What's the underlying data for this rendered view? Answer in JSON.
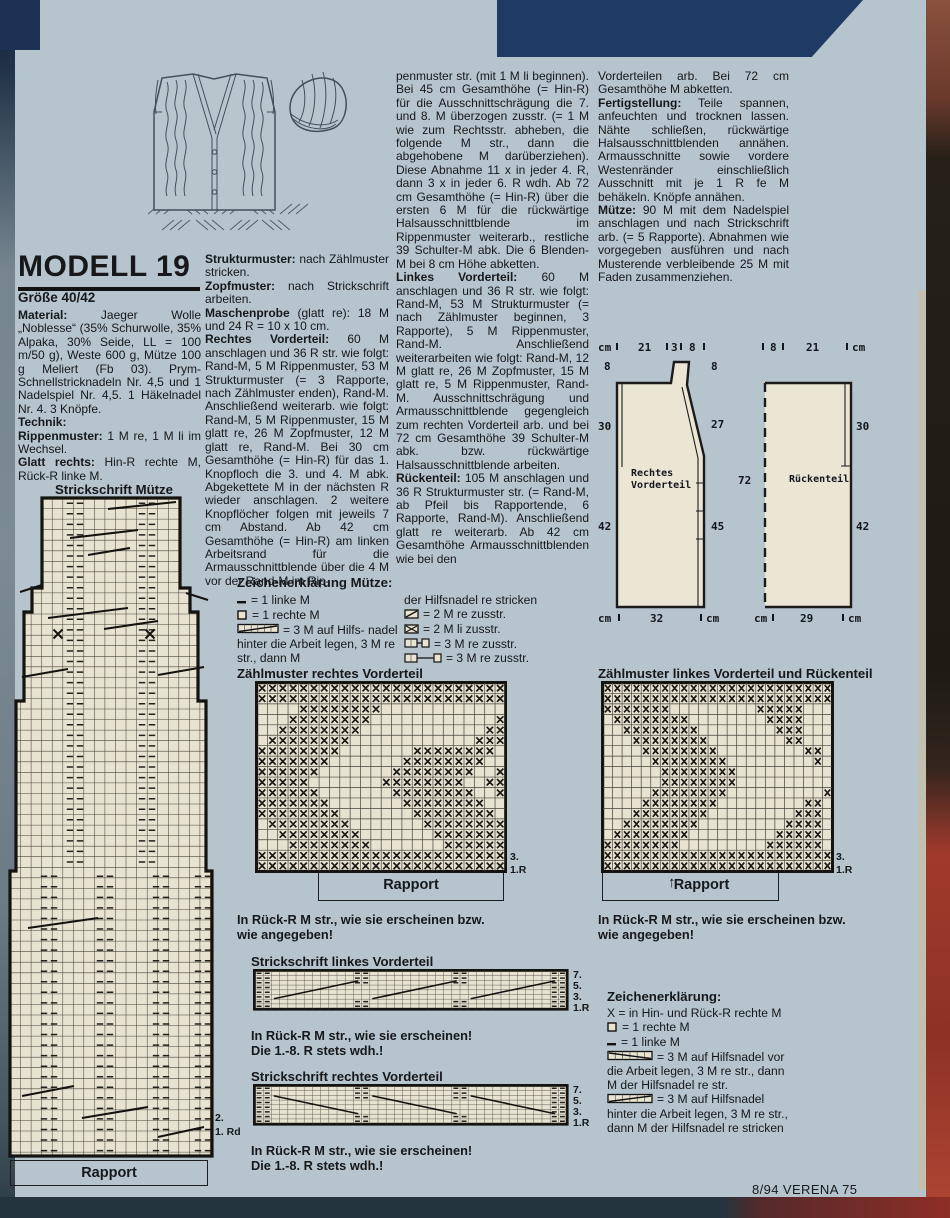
{
  "page": {
    "footer": "8/94 VERENA 75"
  },
  "header": {
    "title": "MODELL 19",
    "size": "Größe 40/42"
  },
  "col1": {
    "paragraphs": [
      {
        "lead": "Material:",
        "text": " Jaeger Wolle „Noblesse“ (35% Schurwolle, 35% Alpaka, 30% Seide, LL = 100 m/50 g), Weste 600 g, Mütze 100 g Meliert (Fb 03). Prym-Schnellstricknadeln Nr. 4,5 und 1 Nadelspiel Nr. 4,5. 1 Häkelnadel Nr. 4. 3 Knöpfe."
      },
      {
        "lead": "Technik:",
        "text": ""
      },
      {
        "lead": "Rippenmuster:",
        "text": " 1 M re, 1 M li im Wechsel."
      },
      {
        "lead": "Glatt rechts:",
        "text": " Hin-R rechte M, Rück-R linke M."
      }
    ]
  },
  "col2": {
    "paragraphs": [
      {
        "lead": "Strukturmuster:",
        "text": " nach Zählmuster stricken."
      },
      {
        "lead": "Zopfmuster:",
        "text": " nach Strickschrift arbeiten."
      },
      {
        "lead": "Maschenprobe",
        "text": " (glatt re): 18 M und 24 R = 10 x 10 cm."
      },
      {
        "lead": "Rechtes Vorderteil:",
        "text": " 60 M anschlagen und 36 R str. wie folgt: Rand-M, 5 M Rippenmuster, 53 M Strukturmuster (= 3 Rapporte, nach Zählmuster enden), Rand-M. Anschließend weiterarb. wie folgt: Rand-M, 5 M Rippenmuster, 15 M glatt re, 26 M Zopfmuster, 12 M glatt re, Rand-M. Bei 30 cm Gesamthöhe (= Hin-R) für das 1. Knopfloch die 3. und 4. M abk. Abgekettete M in der nächsten R wieder anschlagen. 2 weitere Knopflöcher folgen mit jeweils 7 cm Abstand. Ab 42 cm Gesamthöhe (= Hin-R) am linken Arbeitsrand für die Armausschnittblende über die 4 M vor der Rand-M im Rip-"
      }
    ]
  },
  "col3": {
    "paragraphs": [
      {
        "lead": "",
        "text": "penmuster str. (mit 1 M li beginnen). Bei 45 cm Gesamthöhe (= Hin-R) für die Ausschnittschrägung die 7. und 8. M überzogen zusstr. (= 1 M wie zum Rechtsstr. abheben, die folgende M str., dann die abgehobene M darüberziehen). Diese Abnahme 11 x in jeder 4. R, dann 3 x in jeder 6. R wdh. Ab 72 cm Gesamthöhe (= Hin-R) über die ersten 6 M für die rückwärtige Halsausschnittblende im Rippenmuster weiterarb., restliche 39 Schulter-M abk. Die 6 Blenden-M bei 8 cm Höhe abketten."
      },
      {
        "lead": "Linkes Vorderteil:",
        "text": " 60 M anschlagen und 36 R str. wie folgt: Rand-M, 53 M Strukturmuster (= nach Zählmuster beginnen, 3 Rapporte), 5 M Rippenmuster, Rand-M. Anschließend weiterarbeiten wie folgt: Rand-M, 12 M glatt re, 26 M Zopfmuster, 15 M glatt re, 5 M Rippenmuster, Rand-M. Ausschnittschrägung und Armausschnittblende gegengleich zum rechten Vorderteil arb. und bei 72 cm Gesamthöhe 39 Schulter-M abk. bzw. rückwärtige Halsausschnittblende arbeiten."
      },
      {
        "lead": "Rückenteil:",
        "text": " 105 M anschlagen und 36 R Strukturmuster str. (= Rand-M, ab Pfeil bis Rapportende, 6 Rapporte, Rand-M). Anschließend glatt re weiterarb. Ab 42 cm Gesamthöhe Armausschnittblenden wie bei den"
      }
    ]
  },
  "col4": {
    "paragraphs": [
      {
        "lead": "",
        "text": "Vorderteilen arb. Bei 72 cm Gesamthöhe M abketten."
      },
      {
        "lead": "Fertigstellung:",
        "text": " Teile spannen, anfeuchten und trocknen lassen. Nähte schließen, rückwärtige Halsausschnittblenden annähen. Armausschnitte sowie vordere Westenränder einschließlich Ausschnitt mit je 1 R fe M behäkeln. Knöpfe annähen."
      },
      {
        "lead": "Mütze:",
        "text": " 90 M mit dem Nadelspiel anschlagen und nach Strickschrift arb. (= 5 Rapporte). Abnahmen wie vorgegeben ausführen und nach Musterende verbleibende 25 M mit Faden zusammenziehen."
      }
    ]
  },
  "schematics": {
    "left": {
      "name": "Rechtes\nVorderteil",
      "top_labels": [
        "cm",
        "21",
        "3",
        "8"
      ],
      "left_labels": [
        "8",
        "30",
        "42"
      ],
      "right_labels": [
        "8",
        "27",
        "45"
      ],
      "bottom_labels": [
        "cm",
        "32",
        "cm"
      ]
    },
    "right": {
      "name": "Rückenteil",
      "top_labels": [
        "8",
        "21",
        "cm"
      ],
      "left_labels": [
        "72"
      ],
      "right_labels": [
        "30",
        "42"
      ],
      "bottom_labels": [
        "cm",
        "29",
        "cm"
      ]
    }
  },
  "muetze_chart": {
    "title": "Strickschrift Mütze",
    "row_labels": [
      "2.",
      "1. Rd"
    ],
    "rapport": "Rapport"
  },
  "legend_muetze": {
    "title": "Zeichenerklärung Mütze:",
    "col_a": [
      {
        "sym": "dash",
        "text": "= 1 linke M"
      },
      {
        "sym": "box",
        "text": "= 1 rechte M"
      },
      {
        "sym": "cable-back",
        "text": "= 3 M auf Hilfs- nadel hinter die Arbeit legen, 3 M re str., dann M"
      }
    ],
    "col_b": [
      {
        "sym": "",
        "text": "der Hilfsnadel re stricken"
      },
      {
        "sym": "k2tog",
        "text": "= 2 M re zusstr."
      },
      {
        "sym": "p2tog",
        "text": "= 2 M li zusstr."
      },
      {
        "sym": "k3tog-short",
        "text": "= 3 M re zusstr."
      },
      {
        "sym": "k3tog-long",
        "text": "= 3 M re zusstr."
      }
    ]
  },
  "zaehlmuster_rechts": {
    "title": "Zählmuster rechtes Vorderteil",
    "row_labels": [
      "3.",
      "1.R"
    ],
    "rapport": "Rapport",
    "note_lines": [
      "In Rück-R M str., wie sie erscheinen bzw.",
      "wie angegeben!"
    ],
    "rows": [
      "XXXXXXXXXXXXXXXXXXXXXXXX",
      "XXXXXXXXXXXXXXXXXXXXXXXX",
      "....XXXXXXXX............",
      "...XXXXXXXX............X",
      "..XXXXXXXX............XX",
      ".XXXXXXXX............XXX",
      "XXXXXXXX.......XXXXXXXX.",
      "XXXXXXX.......XXXXXXXX..",
      "XXXXXX.......XXXXXXXX..X",
      "XXXXX.......XXXXXXXX..XX",
      "XXXXXX.......XXXXXXXX..X",
      "XXXXXXX.......XXXXXXXX..",
      "XXXXXXXX.......XXXXXXXX.",
      ".XXXXXXXX.......XXXXXXXX",
      "..XXXXXXXX.......XXXXXXX",
      "...XXXXXXXX.......XXXXXX",
      "XXXXXXXXXXXXXXXXXXXXXXXX",
      "XXXXXXXXXXXXXXXXXXXXXXXX"
    ]
  },
  "zaehlmuster_links": {
    "title": "Zählmuster linkes Vorderteil und Rückenteil",
    "row_labels": [
      "3.",
      "1.R"
    ],
    "rapport": "Rapport",
    "note_lines": [
      "In Rück-R M str., wie sie erscheinen bzw.",
      "wie angegeben!"
    ],
    "rows": [
      "XXXXXXXXXXXXXXXXXXXXXXXX",
      "XXXXXXXXXXXXXXXXXXXXXXXX",
      "XXXXXXX.........XXXXX...",
      ".XXXXXXXX........XXXX...",
      "..XXXXXXXX........XXX...",
      "...XXXXXXXX........XX...",
      "....XXXXXXXX.........XX.",
      ".....XXXXXXXX.........X.",
      "......XXXXXXXX..........",
      "......XXXXXXXX..........",
      ".....XXXXXXXX..........X",
      "....XXXXXXXX.........XX.",
      "...XXXXXXXX.........XXX.",
      "..XXXXXXXX.........XXXX.",
      ".XXXXXXXX.........XXXXX.",
      "XXXXXXXX.........XXXXXX.",
      "XXXXXXXXXXXXXXXXXXXXXXXX",
      "XXXXXXXXXXXXXXXXXXXXXXXX"
    ]
  },
  "strickschrift_links": {
    "title": "Strickschrift linkes Vorderteil",
    "row_labels": [
      "7.",
      "5.",
      "3.",
      "1.R"
    ],
    "note_lines": [
      "In Rück-R M str., wie sie erscheinen!",
      "Die 1.-8. R stets wdh.!"
    ]
  },
  "strickschrift_rechts": {
    "title": "Strickschrift rechtes Vorderteil",
    "row_labels": [
      "7.",
      "5.",
      "3.",
      "1.R"
    ],
    "note_lines": [
      "In Rück-R M str., wie sie erscheinen!",
      "Die 1.-8. R stets wdh.!"
    ]
  },
  "legend_main": {
    "title": "Zeichenerklärung:",
    "items": [
      {
        "sym": "",
        "text": "X = in Hin- und Rück-R rechte M"
      },
      {
        "sym": "box",
        "text": "= 1 rechte M"
      },
      {
        "sym": "dash",
        "text": "= 1 linke M"
      },
      {
        "sym": "cable-front",
        "text": "= 3 M auf Hilfsnadel vor die Arbeit legen, 3 M re str., dann M der Hilfsnadel re str."
      },
      {
        "sym": "cable-back",
        "text": "= 3 M auf Hilfsnadel hinter die Arbeit legen, 3 M re str., dann M der Hilfsnadel re stricken"
      }
    ]
  }
}
